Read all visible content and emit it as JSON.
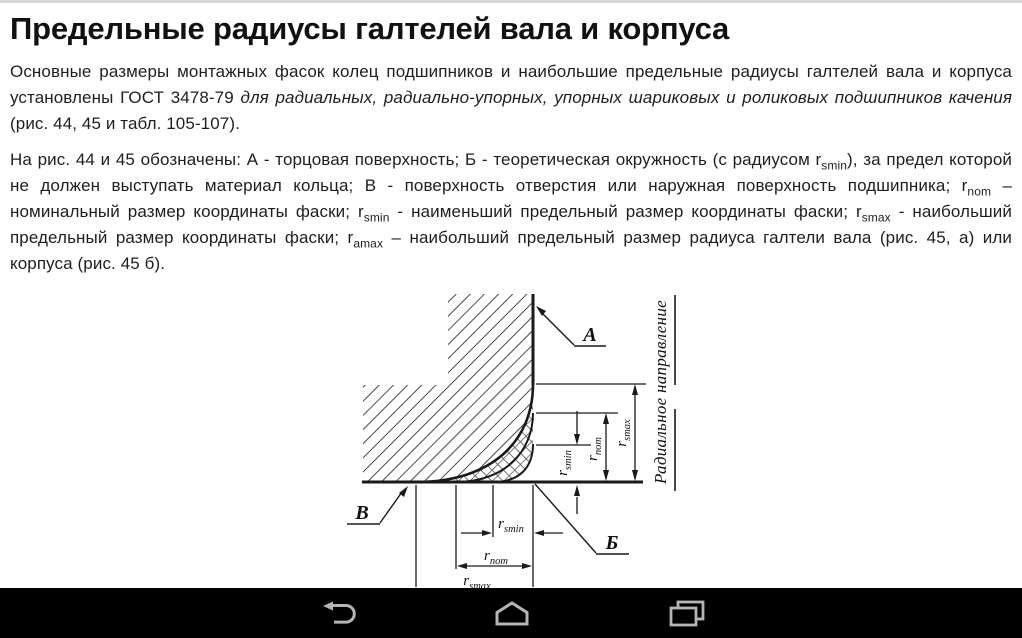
{
  "page": {
    "title": "Предельные радиусы галтелей вала и корпуса",
    "paragraphs": [
      {
        "segments": [
          {
            "text": "Основные размеры монтажных фасок колец подшипников и наибольшие предельные радиусы галтелей вала и корпуса установлены ГОСТ 3478-79 "
          },
          {
            "text": "для радиальных, радиально-упорных, упорных шариковых и роликовых подшипников качения",
            "italic": true
          },
          {
            "text": " (рис. 44, 45 и табл. 105-107)."
          }
        ]
      },
      {
        "segments": [
          {
            "text": "На рис. 44 и 45 обозначены: А - торцовая поверхность; Б - теоретическая окружность (с радиусом r"
          },
          {
            "text": "smin",
            "sub": true
          },
          {
            "text": "), за предел которой не должен выступать материал кольца; В - поверхность отверстия или наружная поверхность подшипника; r"
          },
          {
            "text": "nom",
            "sub": true
          },
          {
            "text": " – номинальный размер координаты фаски; r"
          },
          {
            "text": "smin",
            "sub": true
          },
          {
            "text": " - наименьший предельный размер координаты фаски; r"
          },
          {
            "text": "smax",
            "sub": true
          },
          {
            "text": " - наибольший предельный размер координаты фаски; r"
          },
          {
            "text": "amax",
            "sub": true
          },
          {
            "text": " – наибольший предельный размер радиуса галтели вала (рис. 45, а) или корпуса (рис. 45 б)."
          }
        ]
      }
    ]
  },
  "diagram": {
    "labels": {
      "a": "А",
      "b": "Б",
      "v": "В"
    },
    "radial_direction": "Радиальное направление",
    "dims": {
      "main": "r",
      "smin": "smin",
      "nom": "nom",
      "smax": "smax"
    }
  },
  "navbar": {
    "back_icon": "back-arrow",
    "home_icon": "home",
    "recents_icon": "recent-apps"
  },
  "colors": {
    "background": "#ffffff",
    "text": "#1e1e1e",
    "navbar_bg": "#000000",
    "navbar_icon": "#b5b5b5",
    "diagram_line": "#1a1a1a"
  }
}
